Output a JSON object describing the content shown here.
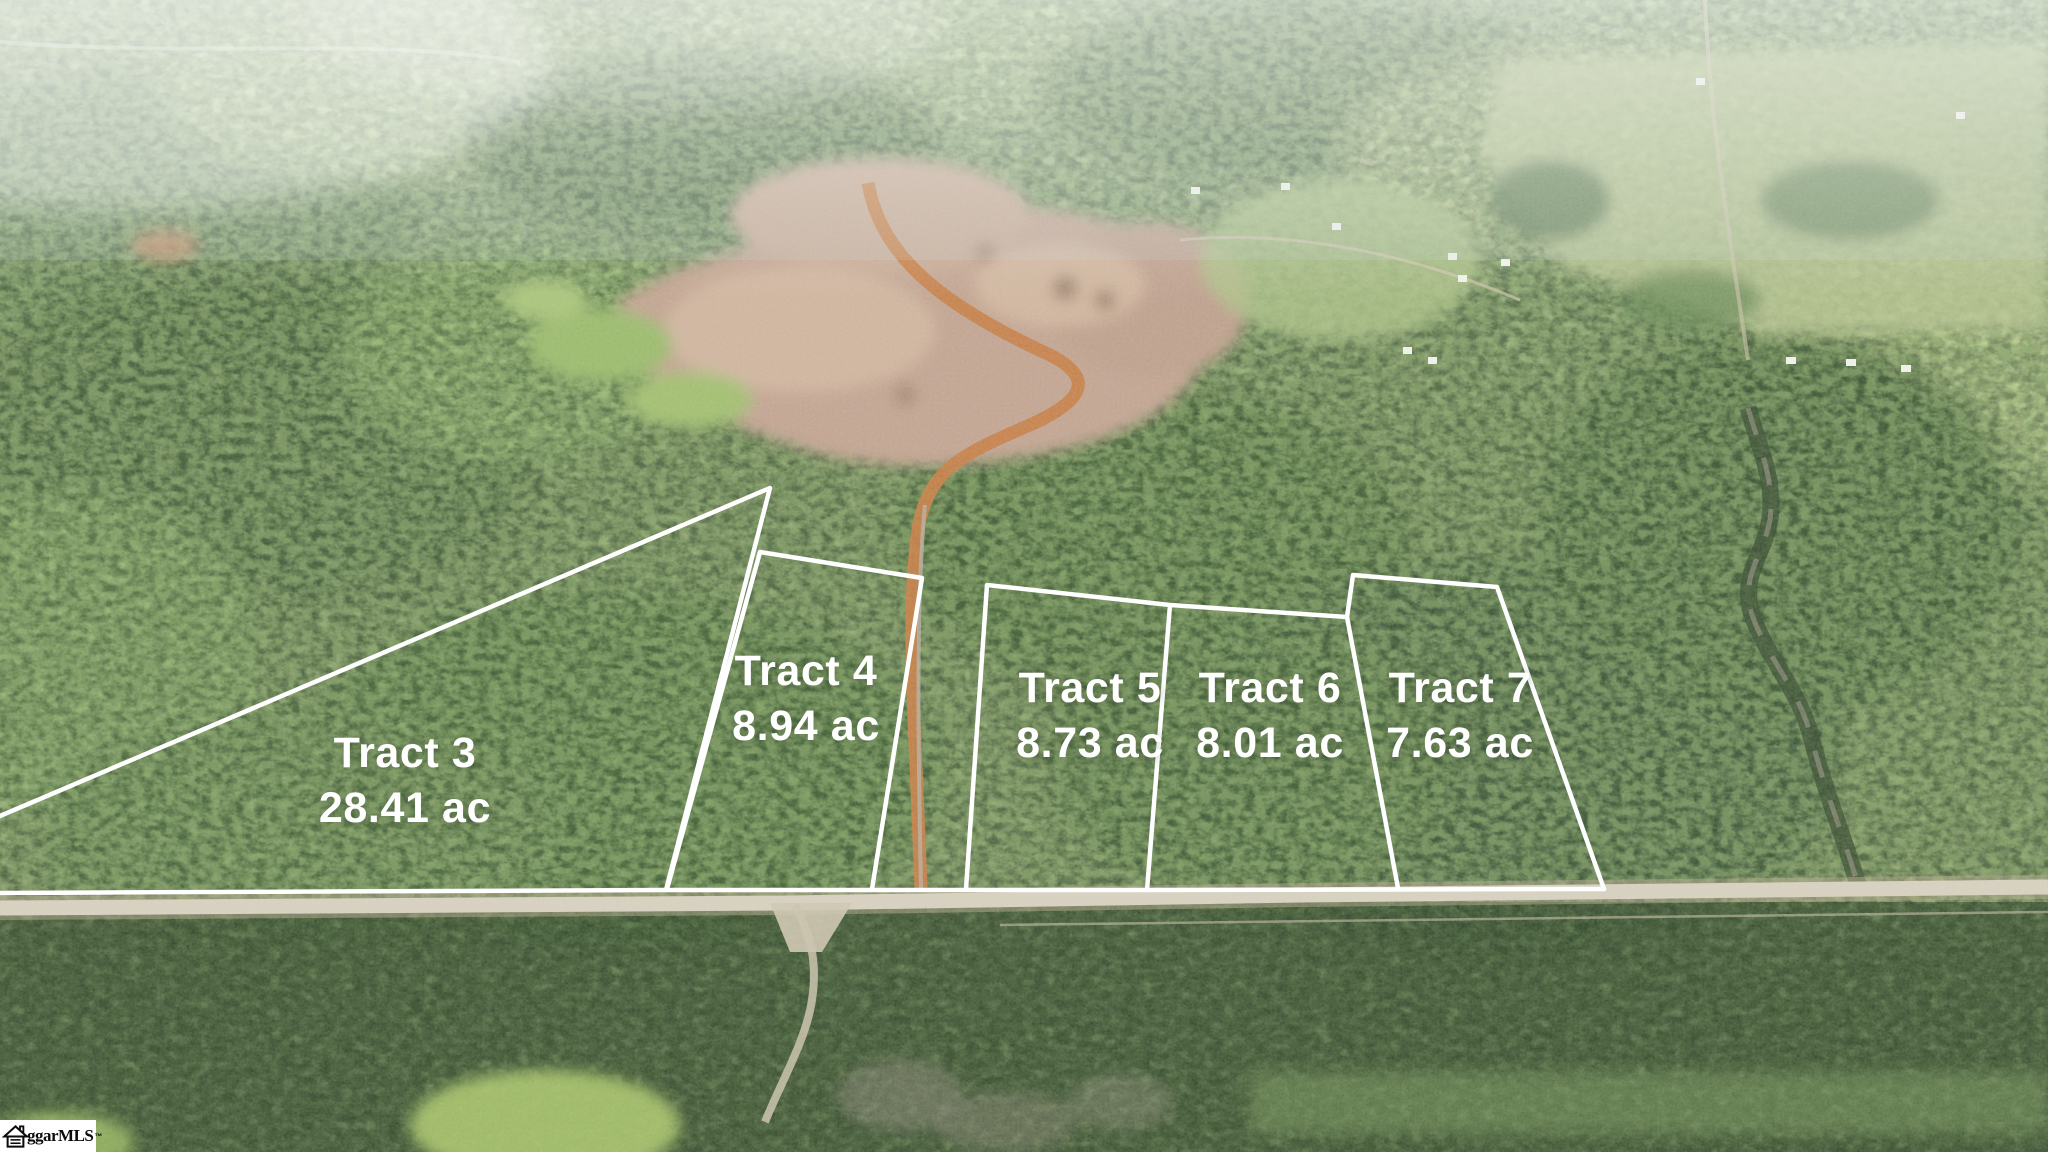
{
  "page": {
    "type": "aerial-property-photo",
    "description": "Aerial drone photo of wooded acreage for sale, surveyed into tracts outlined in white along a road"
  },
  "tracts": [
    {
      "id": "tract-3",
      "name": "Tract 3",
      "acreage": "28.41 ac"
    },
    {
      "id": "tract-4",
      "name": "Tract 4",
      "acreage": "8.94 ac"
    },
    {
      "id": "tract-5",
      "name": "Tract 5",
      "acreage": "8.73 ac"
    },
    {
      "id": "tract-6",
      "name": "Tract 6",
      "acreage": "8.01 ac"
    },
    {
      "id": "tract-7",
      "name": "Tract 7",
      "acreage": "7.63 ac"
    }
  ],
  "watermark": {
    "visible_text": "ggarMLS",
    "trademark": "™",
    "icon": "house-icon"
  },
  "colors": {
    "boundary_line": "#ffffff",
    "label_text": "#ffffff",
    "forest_green": "#66824f",
    "clearcut_tan": "#c3a493",
    "dirt_road_orange": "#c87f48",
    "paved_road_gray": "#d7d0c0",
    "watermark_bg": "#ffffff",
    "watermark_text": "#0b0b0b"
  }
}
